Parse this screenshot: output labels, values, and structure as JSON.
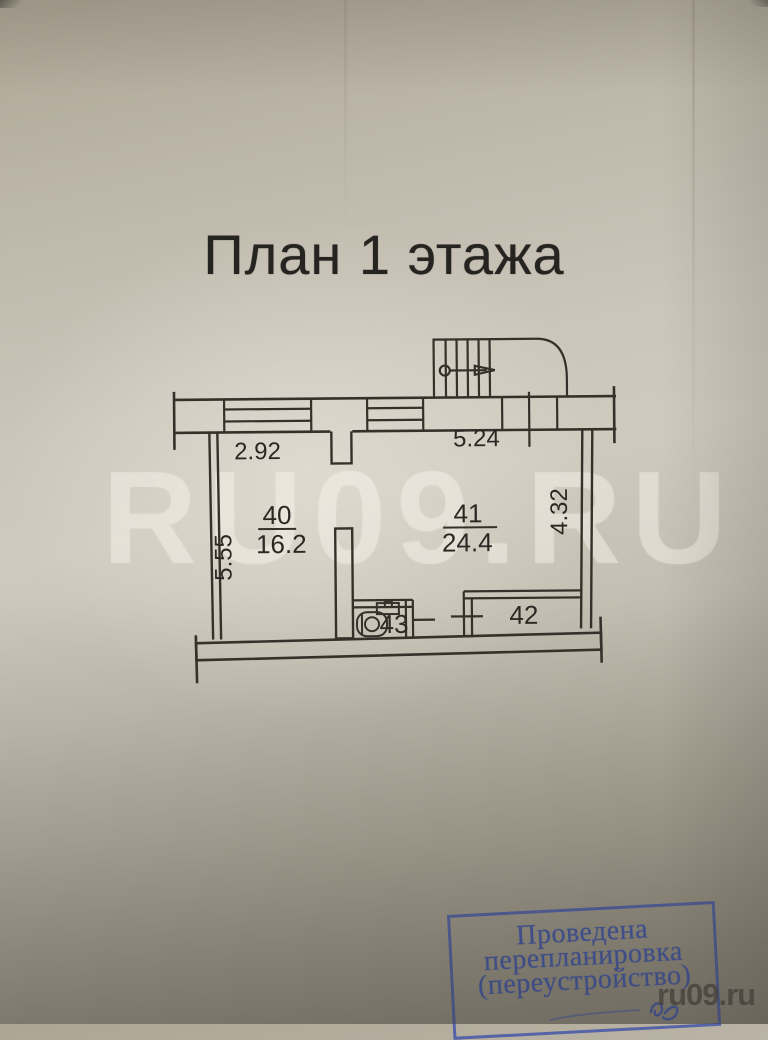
{
  "page": {
    "title": "План 1 этажа"
  },
  "floor_plan": {
    "rooms": [
      {
        "number": "40",
        "area": "16.2"
      },
      {
        "number": "41",
        "area": "24.4"
      },
      {
        "number": "42",
        "area": ""
      },
      {
        "number": "43",
        "area": ""
      }
    ],
    "dimensions": {
      "top_left": "2.92",
      "top_right": "5.24",
      "left_side": "5.55",
      "right_side": "4.32"
    },
    "ink_color": "#35312a"
  },
  "stamp": {
    "line1": "Проведена",
    "line2": "перепланировка",
    "line3": "(переустройство)",
    "color": "#4156a4"
  },
  "watermarks": {
    "center": "RU09.RU",
    "corner": "ru09.ru"
  },
  "paper_color": "#c9c4b8"
}
